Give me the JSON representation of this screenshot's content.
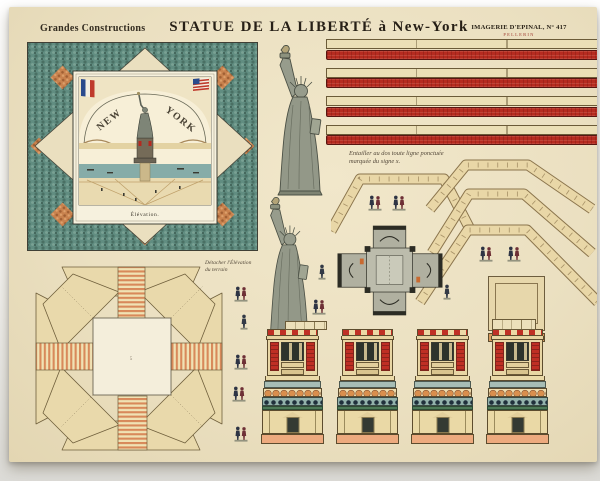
{
  "header": {
    "series": "Grandes Constructions",
    "title": "STATUE DE LA LIBERTÉ à New-York",
    "publisher": "IMAGERIE D'EPINAL, N° 417",
    "publisher_sub": "PELLERIN"
  },
  "elevation": {
    "arc_left": "NEW",
    "arc_right": "YORK",
    "caption": "Élévation."
  },
  "notes": {
    "detach_line1": "Détacher l'Élévation",
    "detach_line2": "du terrain",
    "entailler_line1": "Entailler au dos toute ligne ponctuée",
    "entailler_line2": "marquée du signe x."
  },
  "palette": {
    "paper": "#ebe0c2",
    "brick_red": "#b62b20",
    "mosaic_teal": "#618d81",
    "accent_orange": "#c8824e",
    "piece_tan": "#e8d6a6",
    "statue_gray": "#939888",
    "band_blue": "#93b2ab",
    "plinth_salmon": "#edaa7e",
    "roof_green": "#4e7a58",
    "ink": "#2a2318"
  }
}
